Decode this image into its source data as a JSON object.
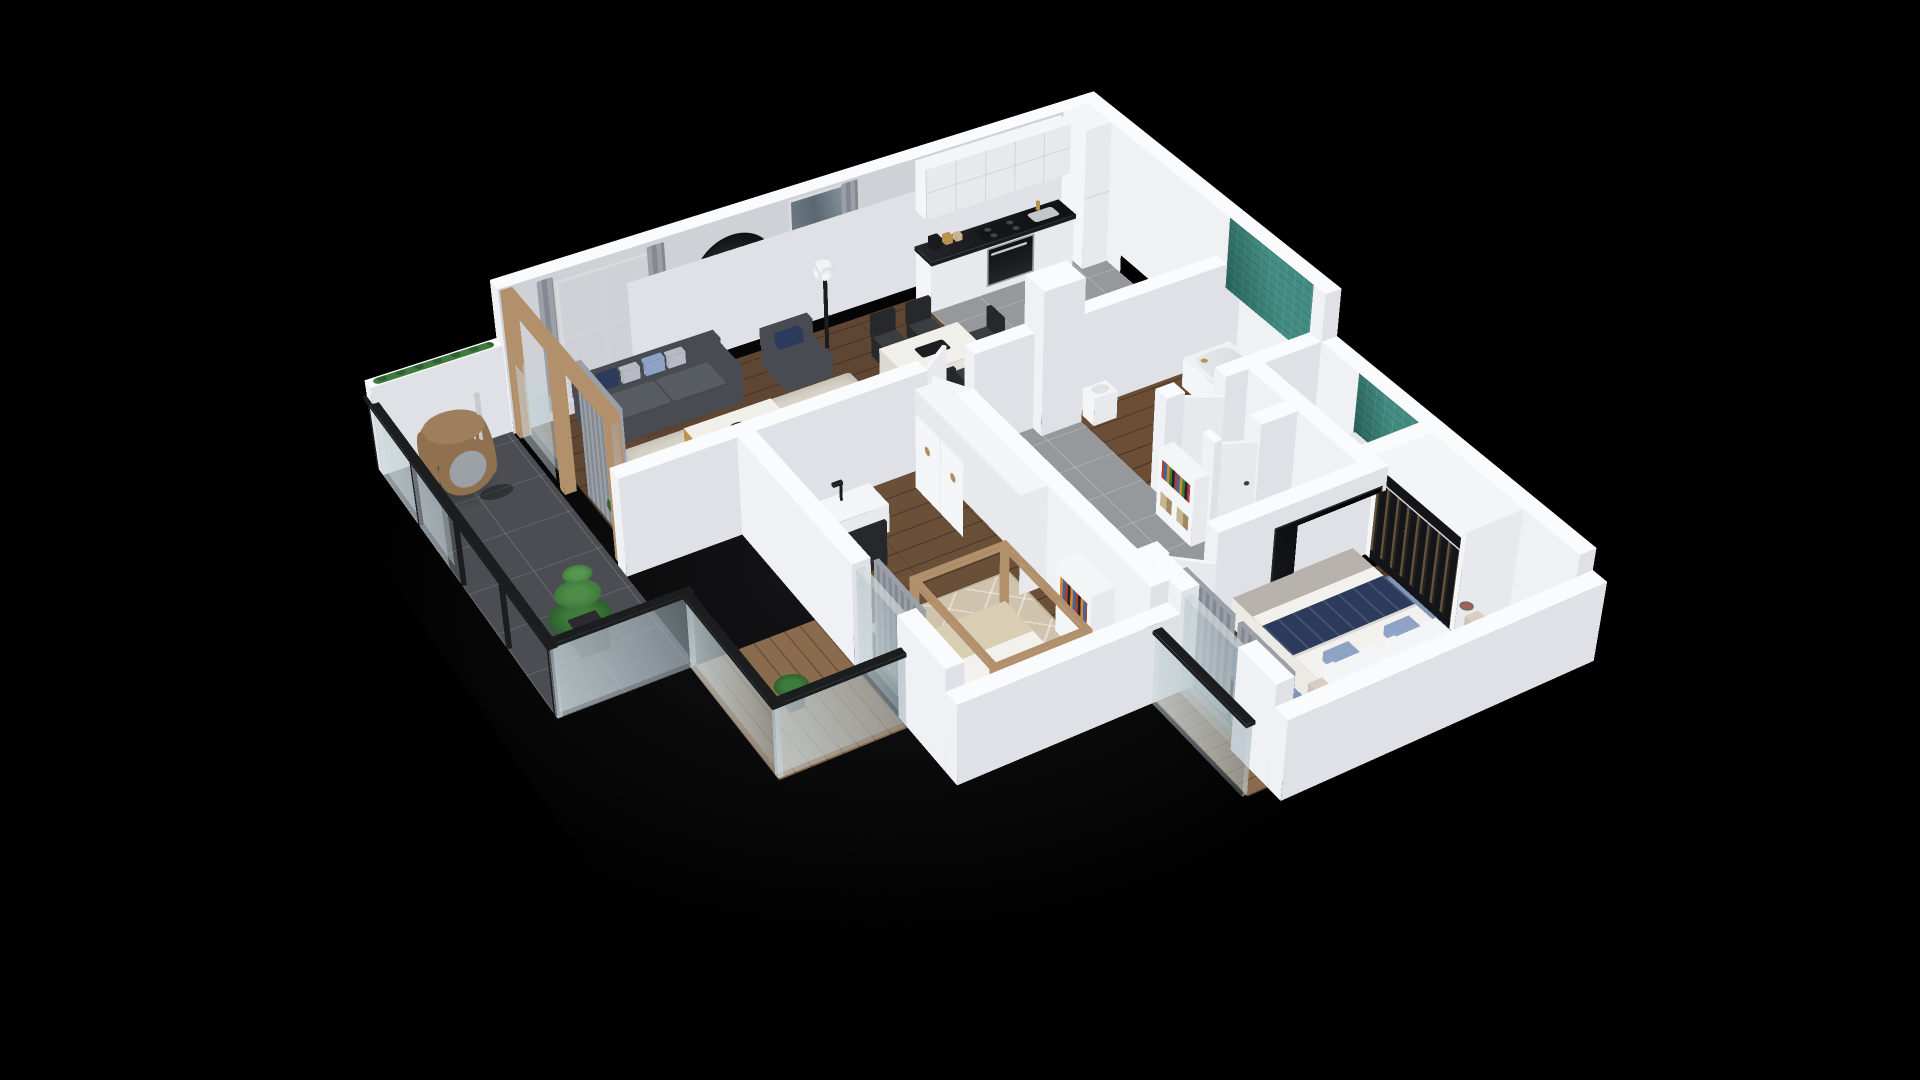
{
  "scene": {
    "type": "3d-isometric-floor-plan-render",
    "description": "Photorealistic 3D cutaway floor plan of a two-bedroom apartment with balcony, rendered on a black background. White cut walls, dark walnut wood floors, grey tile wet areas, teal mosaic accents in bathroom and laundry niche.",
    "background": "#000000",
    "camera": {
      "style": "axonometric with mild perspective",
      "rotateX_deg": 54,
      "rotateZ_deg": -31
    }
  },
  "rooms": [
    {
      "name": "living-room",
      "floor": "dark walnut plank",
      "features": [
        "grey sofa with navy pillows",
        "marble and gold coffee table",
        "grey armchair",
        "cream shag rug",
        "floor lamp",
        "tv on low bench",
        "round dark wall mirror",
        "window with grey curtains",
        "wood framed sliding door"
      ]
    },
    {
      "name": "dining-area",
      "floor": "dark walnut plank",
      "features": [
        "white marble dining table",
        "five dark grey chairs",
        "tall window with curtain"
      ]
    },
    {
      "name": "kitchen",
      "floor": "grey tile",
      "features": [
        "white panel cabinets",
        "black stone countertop",
        "upper cabinets with brass knobs",
        "oven and hob",
        "tall cabinet",
        "counter jars and kettle"
      ]
    },
    {
      "name": "bathroom",
      "floor": "wood plank",
      "features": [
        "white bathtub",
        "teal mosaic tile wall",
        "washbasin"
      ]
    },
    {
      "name": "wc",
      "floor": "wood plank",
      "features": [
        "toilet"
      ]
    },
    {
      "name": "hallway",
      "floor": "grey tile",
      "features": [
        "white doors ajar",
        "open white bookshelf with books"
      ]
    },
    {
      "name": "laundry-niche",
      "floor": "grey tile",
      "features": [
        "washing machine",
        "teal mosaic tile wall"
      ]
    },
    {
      "name": "wardrobe-closet",
      "features": [
        "open wardrobe with hanging clothes",
        "brass rail"
      ]
    },
    {
      "name": "master-bedroom",
      "floor": "dark walnut plank",
      "features": [
        "double bed with white duvet and navy runner",
        "floral accent pillows",
        "two nightstands with lamps",
        "blue patterned rug",
        "wall tv",
        "grey curtains",
        "headboard",
        "potted plant"
      ]
    },
    {
      "name": "kids-room",
      "floor": "walnut plank",
      "features": [
        "white desk",
        "black chair",
        "desk lamp",
        "white cabinet wall",
        "house frame wood bed",
        "beige diamond rug",
        "bookshelf",
        "potted plant",
        "curtained glass door"
      ]
    },
    {
      "name": "balcony",
      "floor": "dark grey tile",
      "features": [
        "rattan hanging egg chair",
        "potted tree",
        "black framed glass railing",
        "planter hedge on parapet"
      ]
    },
    {
      "name": "terrace",
      "floor": "wood deck",
      "features": [
        "black framed glass railing"
      ]
    }
  ],
  "palette": {
    "background": "#000000",
    "wall_top": "#fafbfc",
    "wall_sun": "#f0f1f4",
    "wall_shade": "#dfe1e6",
    "wall_inner": "#cfd1d7",
    "wall_inner_dark": "#bfc1c8",
    "floor_living": "#5e4632",
    "floor_bedroom": "#54402e",
    "floor_kids": "#6a4f39",
    "floor_wc": "#6b4e35",
    "deck": "#8a6b4e",
    "tile_grey": "#97989c",
    "tile_balcony": "#4b4d52",
    "teal": "#2e7f73",
    "teal_dark": "#1d5c54",
    "glass": "rgba(168,184,189,0.38)",
    "rail_dark": "#1c1d1f",
    "sofa": "#484b51",
    "sofa_seat": "#585c63",
    "navy": "#2c3a5c",
    "pillow_grey": "#b6bac2",
    "floral": "#8fa3c6",
    "marble": "#f1efe9",
    "gold": "#b9924e",
    "rug_cream": "#d9d5ca",
    "rug_beige": "#cfc3ae",
    "rug_blue": "#8096b4",
    "white": "#f4f5f7",
    "off_white": "#e8e9ec",
    "counter": "#1b1c1f",
    "appliance": "#d7d9dc",
    "tv": "#0d0e11",
    "curtain": "#9ba0a8",
    "curtain_dark": "#84888f",
    "plant": "#3e7b3c",
    "plant_dark": "#2e5f2e",
    "pot": "#2a2b2e",
    "rattan": "#8f7150",
    "cushion": "#9ba1a7",
    "wood_frame": "#b3906c",
    "bedding": "#eceae5",
    "duvet": "#f2f1ed",
    "throw": "#b7b3ac",
    "headboard": "#d9dade",
    "clothes": "#17181b",
    "book_red": "#b23b32",
    "book_blue": "#2e6da8",
    "book_orange": "#d7862c",
    "book_green": "#3a7a3a",
    "lamp_shade": "#d8cfc2",
    "chair_black": "#26282b",
    "shadow": "rgba(0,0,0,0.28)"
  }
}
